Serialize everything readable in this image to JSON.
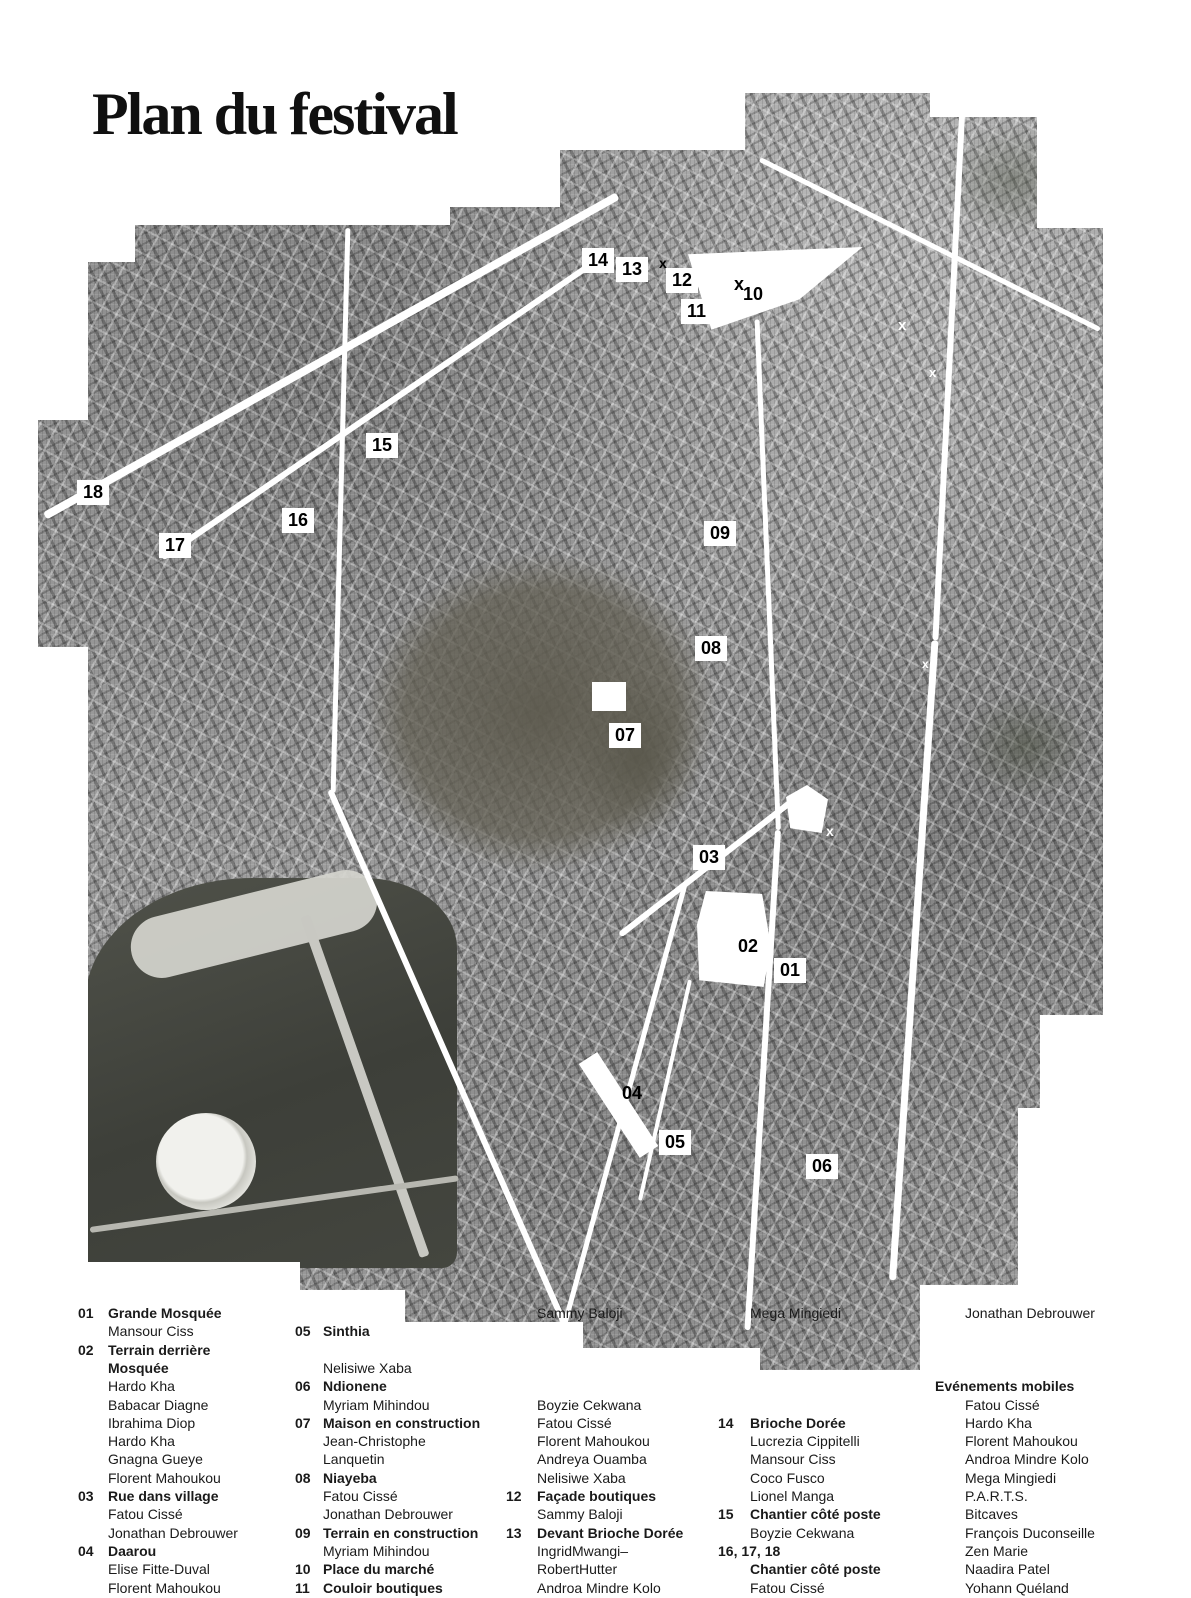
{
  "title": "Plan du festival",
  "map": {
    "markers": [
      {
        "label": "14",
        "x": 582,
        "y": 248,
        "boxed": true
      },
      {
        "label": "13",
        "x": 616,
        "y": 257,
        "boxed": true
      },
      {
        "label": "12",
        "x": 666,
        "y": 268,
        "boxed": true
      },
      {
        "label": "11",
        "x": 681,
        "y": 299,
        "boxed": true
      },
      {
        "label": "10",
        "x": 743,
        "y": 284,
        "boxed": false
      },
      {
        "label": "15",
        "x": 366,
        "y": 433,
        "boxed": true
      },
      {
        "label": "18",
        "x": 77,
        "y": 480,
        "boxed": true
      },
      {
        "label": "17",
        "x": 159,
        "y": 533,
        "boxed": true
      },
      {
        "label": "16",
        "x": 282,
        "y": 508,
        "boxed": true
      },
      {
        "label": "09",
        "x": 704,
        "y": 521,
        "boxed": true
      },
      {
        "label": "08",
        "x": 695,
        "y": 636,
        "boxed": true
      },
      {
        "label": "07",
        "x": 609,
        "y": 723,
        "boxed": true
      },
      {
        "label": "03",
        "x": 693,
        "y": 845,
        "boxed": true
      },
      {
        "label": "02",
        "x": 738,
        "y": 936,
        "boxed": false
      },
      {
        "label": "01",
        "x": 774,
        "y": 958,
        "boxed": true
      },
      {
        "label": "04",
        "x": 622,
        "y": 1083,
        "boxed": false
      },
      {
        "label": "05",
        "x": 659,
        "y": 1130,
        "boxed": true
      },
      {
        "label": "06",
        "x": 806,
        "y": 1154,
        "boxed": true
      }
    ],
    "x_marks": [
      {
        "glyph": "x",
        "x": 659,
        "y": 256,
        "color": "#000000",
        "size": 14
      },
      {
        "glyph": "x",
        "x": 734,
        "y": 275,
        "color": "#000000",
        "size": 18
      },
      {
        "glyph": "x",
        "x": 898,
        "y": 318,
        "color": "#ffffff",
        "size": 15
      },
      {
        "glyph": "x",
        "x": 929,
        "y": 366,
        "color": "#ffffff",
        "size": 13
      },
      {
        "glyph": "x",
        "x": 922,
        "y": 658,
        "color": "#ffffff",
        "size": 12
      },
      {
        "glyph": "x",
        "x": 826,
        "y": 824,
        "color": "#ffffff",
        "size": 14
      }
    ]
  },
  "colors": {
    "marker_bg": "#ffffff",
    "marker_text": "#000000",
    "map_gray": "#9d9d9d"
  },
  "legend": {
    "columns": [
      {
        "rows": [
          {
            "r": 1,
            "n": "01",
            "t": "Grande Mosquée",
            "b": true
          },
          {
            "r": 2,
            "t": "Mansour Ciss"
          },
          {
            "r": 3,
            "n": "02",
            "t": "Terrain derrière",
            "b": true
          },
          {
            "r": 4,
            "t": "Mosquée",
            "b": true
          },
          {
            "r": 5,
            "t": "Hardo Kha"
          },
          {
            "r": 6,
            "t": "Babacar Diagne"
          },
          {
            "r": 7,
            "t": "Ibrahima Diop"
          },
          {
            "r": 8,
            "t": "Hardo Kha"
          },
          {
            "r": 9,
            "t": "Gnagna Gueye"
          },
          {
            "r": 10,
            "t": "Florent Mahoukou"
          },
          {
            "r": 11,
            "n": "03",
            "t": "Rue dans village",
            "b": true
          },
          {
            "r": 12,
            "t": "Fatou Cissé"
          },
          {
            "r": 13,
            "t": "Jonathan Debrouwer"
          },
          {
            "r": 14,
            "n": "04",
            "t": "Daarou",
            "b": true
          },
          {
            "r": 15,
            "t": "Elise Fitte-Duval"
          },
          {
            "r": 16,
            "t": "Florent Mahoukou"
          }
        ]
      },
      {
        "rows": [
          {
            "r": 2,
            "n": "05",
            "t": "Sinthia",
            "b": true
          },
          {
            "r": 4,
            "t": "Nelisiwe Xaba"
          },
          {
            "r": 5,
            "n": "06",
            "t": "Ndionene",
            "b": true
          },
          {
            "r": 6,
            "t": "Myriam Mihindou"
          },
          {
            "r": 7,
            "n": "07",
            "t": "Maison en construction",
            "b": true
          },
          {
            "r": 8,
            "t": "Jean-Christophe"
          },
          {
            "r": 9,
            "t": "Lanquetin"
          },
          {
            "r": 10,
            "n": "08",
            "t": "Niayeba",
            "b": true
          },
          {
            "r": 11,
            "t": "Fatou Cissé"
          },
          {
            "r": 12,
            "t": "Jonathan Debrouwer"
          },
          {
            "r": 13,
            "n": "09",
            "t": "Terrain en construction",
            "b": true
          },
          {
            "r": 14,
            "t": "Myriam Mihindou"
          },
          {
            "r": 15,
            "n": "10",
            "t": "Place du marché",
            "b": true
          },
          {
            "r": 16,
            "n": "11",
            "t": "Couloir boutiques",
            "b": true
          }
        ]
      },
      {
        "rows": [
          {
            "r": 1,
            "t": "Sammy Baloji"
          },
          {
            "r": 6,
            "t": "Boyzie Cekwana"
          },
          {
            "r": 7,
            "t": "Fatou Cissé"
          },
          {
            "r": 8,
            "t": "Florent Mahoukou"
          },
          {
            "r": 9,
            "t": "Andreya Ouamba"
          },
          {
            "r": 10,
            "t": "Nelisiwe Xaba"
          },
          {
            "r": 11,
            "n": "12",
            "t": "Façade boutiques",
            "b": true
          },
          {
            "r": 12,
            "t": "Sammy Baloji"
          },
          {
            "r": 13,
            "n": "13",
            "t": "Devant Brioche Dorée",
            "b": true
          },
          {
            "r": 14,
            "t": "IngridMwangi–"
          },
          {
            "r": 15,
            "t": "RobertHutter"
          },
          {
            "r": 16,
            "t": "Androa Mindre Kolo"
          }
        ]
      },
      {
        "rows": [
          {
            "r": 1,
            "t": "Mega Mingiedi"
          },
          {
            "r": 7,
            "n": "14",
            "t": "Brioche Dorée",
            "b": true
          },
          {
            "r": 8,
            "t": "Lucrezia Cippitelli"
          },
          {
            "r": 9,
            "t": "Mansour Ciss"
          },
          {
            "r": 10,
            "t": "Coco Fusco"
          },
          {
            "r": 11,
            "t": "Lionel Manga"
          },
          {
            "r": 12,
            "n": "15",
            "t": "Chantier côté poste",
            "b": true
          },
          {
            "r": 13,
            "t": "Boyzie Cekwana"
          },
          {
            "r": 14,
            "n": "16, 17, 18"
          },
          {
            "r": 15,
            "t": "Chantier côté poste",
            "b": true
          },
          {
            "r": 16,
            "t": "Fatou Cissé"
          }
        ]
      },
      {
        "rows": [
          {
            "r": 1,
            "t": "Jonathan Debrouwer"
          },
          {
            "r": 5,
            "t": "Evénements mobiles",
            "h": true
          },
          {
            "r": 6,
            "t": "Fatou Cissé"
          },
          {
            "r": 7,
            "t": "Hardo Kha"
          },
          {
            "r": 8,
            "t": "Florent Mahoukou"
          },
          {
            "r": 9,
            "t": "Androa Mindre Kolo"
          },
          {
            "r": 10,
            "t": "Mega Mingiedi"
          },
          {
            "r": 11,
            "t": "P.A.R.T.S."
          },
          {
            "r": 12,
            "t": "Bitcaves"
          },
          {
            "r": 13,
            "t": "François Duconseille"
          },
          {
            "r": 14,
            "t": "Zen Marie"
          },
          {
            "r": 15,
            "t": "Naadira Patel"
          },
          {
            "r": 16,
            "t": "Yohann Quéland"
          }
        ]
      }
    ]
  }
}
